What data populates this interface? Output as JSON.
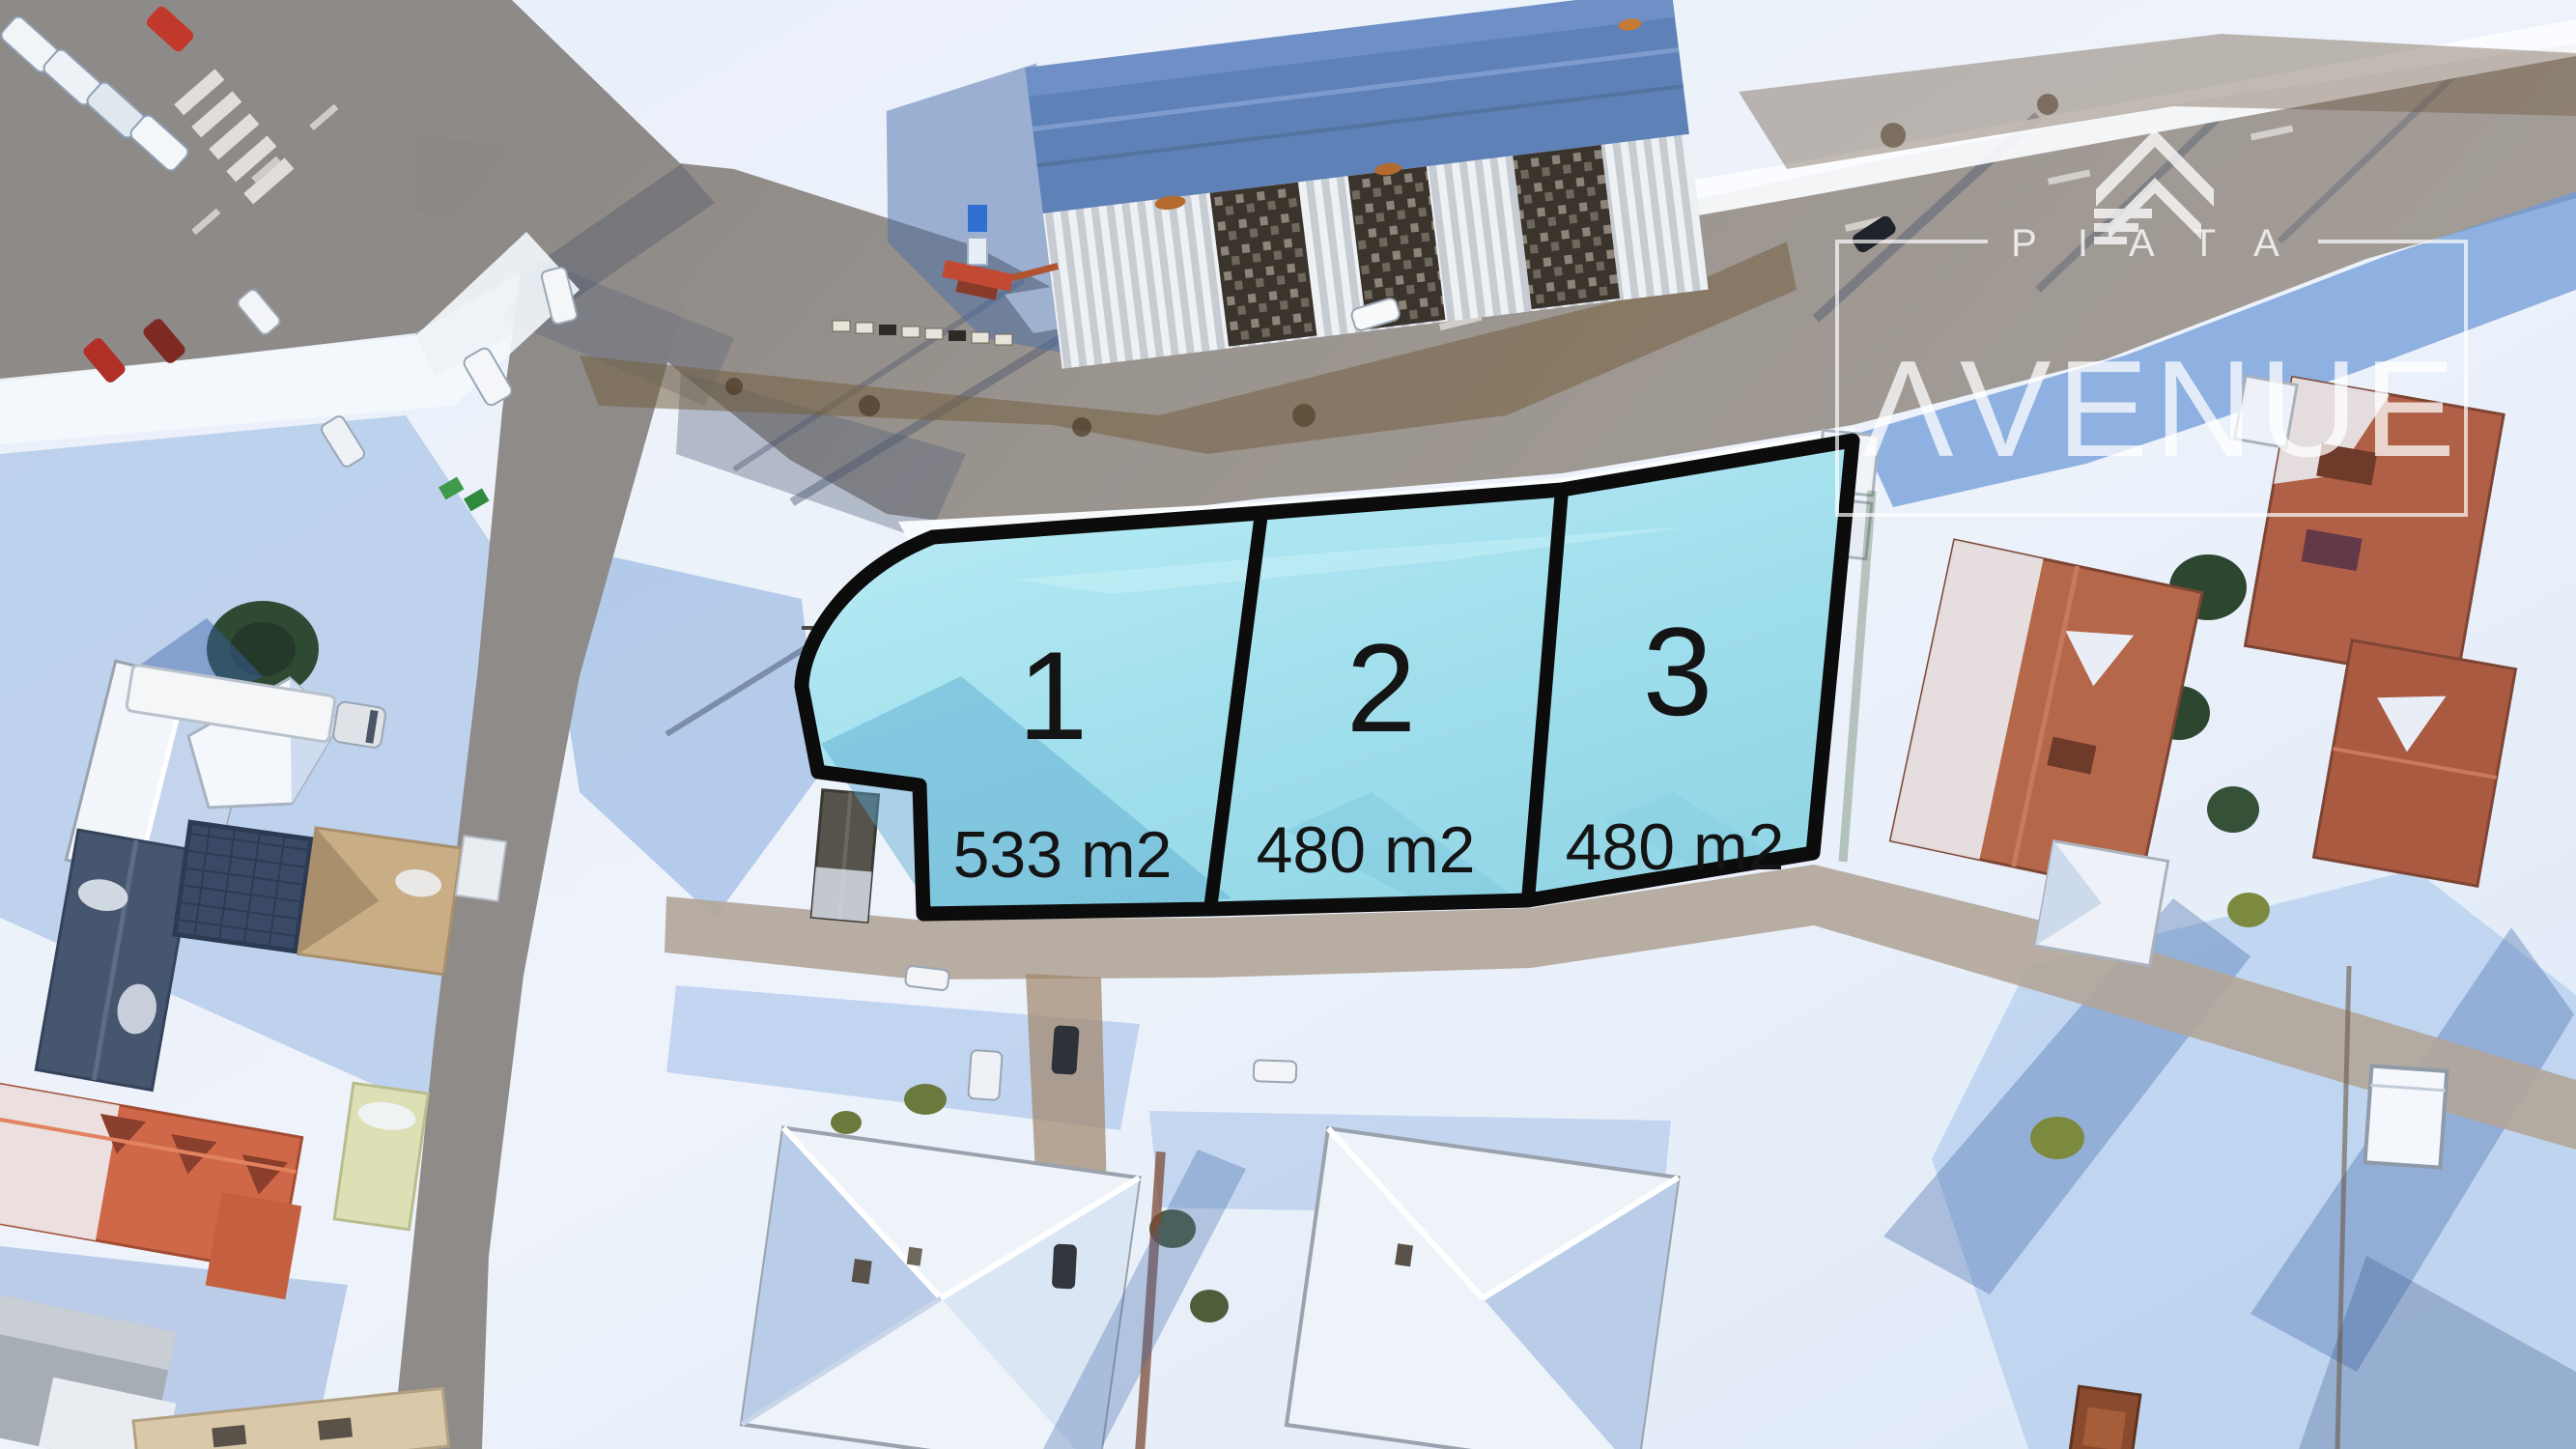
{
  "watermark": {
    "brand_top": "PIATA",
    "brand_bottom": "AVENUE",
    "icon": "double-chevron-up-logo-icon"
  },
  "parcels": [
    {
      "number": "1",
      "area": "533 m2"
    },
    {
      "number": "2",
      "area": "480 m2"
    },
    {
      "number": "3",
      "area": "480 m2"
    }
  ],
  "colors": {
    "parcel_fill": "#9fdde9",
    "parcel_fill_light": "#bceef6",
    "parcel_outline": "#0c0c0c",
    "label_text": "#141414",
    "watermark_white": "#ffffff",
    "road_asphalt": "#928d89",
    "snow_white": "#f6f9fd",
    "snow_shadow_blue": "#6f9bd8",
    "roof_terracotta": "#b5674a",
    "roof_orange": "#cf6848",
    "warehouse_roof_blue": "#5e81b8"
  }
}
